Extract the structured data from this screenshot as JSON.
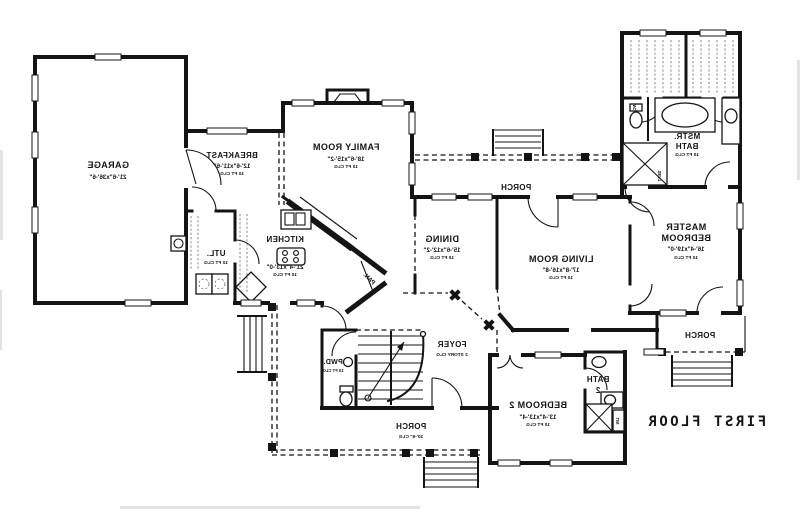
{
  "title": "FIRST FLOOR",
  "colors": {
    "wall": "#141414",
    "background": "#ffffff"
  },
  "rooms": {
    "garage": {
      "name": "GARAGE",
      "dims": "21'-6\"x36'-6\""
    },
    "breakfast": {
      "name": "BREAKFAST",
      "dims": "12'-6\"x11'-6\"",
      "clg": "10 FT CLG"
    },
    "family_room": {
      "name": "FAMILY ROOM",
      "dims": "18'-6\"x15'-2\"",
      "clg": "10 FT CLG"
    },
    "kitchen": {
      "name": "KITCHEN",
      "dims": "21'-4\"x13'-0\"",
      "clg": "10 FT CLG"
    },
    "utility": {
      "name": "UTL.",
      "clg": "10 FT CLG"
    },
    "pantry": {
      "name": "PAN."
    },
    "dining": {
      "name": "DINING",
      "dims": "15'-6\"x12'-2\"",
      "clg": "10 FT CLG"
    },
    "living_room": {
      "name": "LIVING ROOM",
      "dims": "17'-8\"x16'-8\"",
      "clg": "10 FT CLG"
    },
    "master_bedroom": {
      "line1": "MASTER",
      "line2": "BEDROOM",
      "dims": "16'-4\"x19'-0\"",
      "clg": "10 FT CLG"
    },
    "master_bath": {
      "line1": "MSTR.",
      "line2": "BATH",
      "clg": "10 FT CLG"
    },
    "bedroom_2": {
      "name": "BEDROOM 2",
      "dims": "13'-4\"x13'-4\"",
      "clg": "10 FT CLG"
    },
    "bath_2": {
      "line1": "BATH",
      "line2": "2"
    },
    "foyer": {
      "name": "FOYER",
      "clg": "2 STORY CLG"
    },
    "powder": {
      "name": "PWD.",
      "clg": "10 FT CLG"
    },
    "porch_top": {
      "name": "PORCH"
    },
    "porch_front": {
      "name": "PORCH",
      "clg": "10'-6\" CLG"
    },
    "porch_right": {
      "name": "PORCH"
    }
  },
  "fixture_labels": {
    "wc": "WC",
    "seat": "SEAT",
    "linen": "LIN"
  }
}
